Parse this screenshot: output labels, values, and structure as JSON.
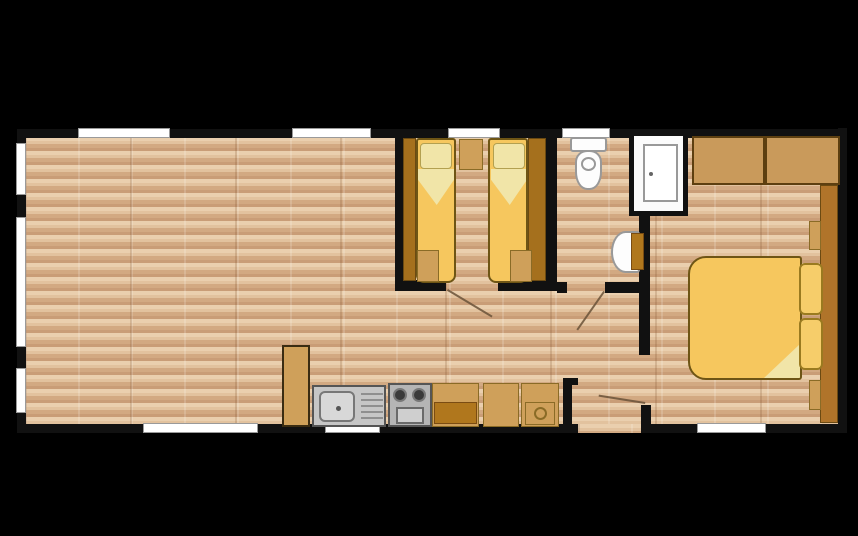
{
  "colors": {
    "bg": "#000000",
    "wall": "#111111",
    "window": "#ffffff",
    "window_edge": "#9a9a9a",
    "floor_a": "#eacfae",
    "floor_b": "#d2a982",
    "wood_dark": "#a5701d",
    "wood_mid": "#c99a5b",
    "wood_light": "#cfa05a",
    "wood_front": "#b0771d",
    "bed": "#f6c75e",
    "bed_edge": "#6e5515",
    "pillow": "#f1e5a8",
    "pillow_edge": "#b3a050",
    "steel": "#c6c6c6",
    "steel_edge": "#555555",
    "fixture_edge": "#999999",
    "swing": "#6a5238"
  },
  "floorplan": {
    "type": "static-caravan-floor-plan",
    "rooms": [
      "living-dining-area",
      "kitchen",
      "twin-bedroom",
      "shower-room",
      "hallway",
      "double-bedroom"
    ],
    "fixtures": [
      "twin-bed-1",
      "twin-bed-2",
      "twin-wardrobes",
      "bedside-cabinet",
      "toilet",
      "washbasin",
      "shower-cubicle",
      "double-bed",
      "overhead-wardrobes",
      "bedside-shelves",
      "kitchen-sink-drainer",
      "cooker-with-oven",
      "kitchen-base-units",
      "tall-larder-unit"
    ],
    "windows_count": 10,
    "door_openings_count": 4
  }
}
